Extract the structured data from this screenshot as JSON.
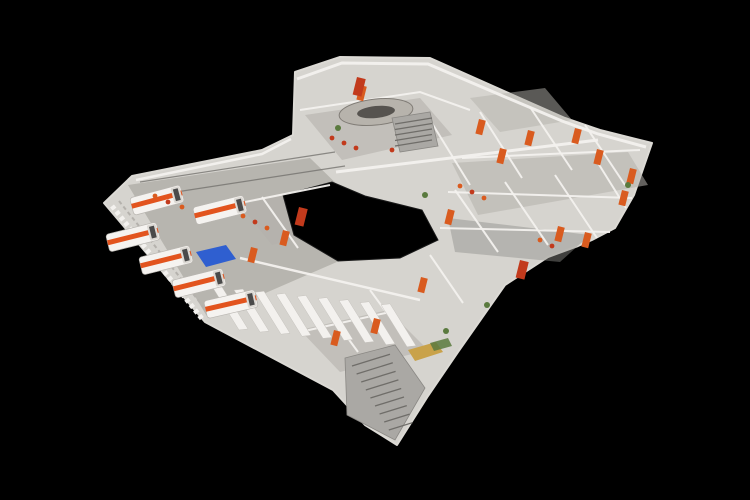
{
  "scene": {
    "type": "3d-dollhouse-scan",
    "subject": "cutaway building scan with ambulance garage, offices and staircases",
    "background": "#000000",
    "palette": {
      "floor_light": "#d6d4cf",
      "floor_mid": "#b4b1ab",
      "floor_dark": "#8f8d89",
      "wall_white": "#f3f1ee",
      "wall_shade": "#dcdad5",
      "accent_orange": "#d95b1f",
      "accent_red": "#c23a1c",
      "ambulance_body": "#f5f3f0",
      "ambulance_stripe": "#e2541e",
      "tarp_blue": "#2f5fd0",
      "table_wood": "#c9a24a",
      "stair_tread": "#aaa8a4",
      "plant_green": "#5a7a3e",
      "line_dark": "#6f6d69"
    },
    "ambulances": [
      [
        133,
        237,
        -14
      ],
      [
        166,
        260,
        -14
      ],
      [
        199,
        283,
        -14
      ],
      [
        231,
        304,
        -13
      ],
      [
        220,
        210,
        -14
      ],
      [
        157,
        200,
        -15
      ]
    ],
    "orange_doors": [
      [
        360,
        85
      ],
      [
        479,
        119
      ],
      [
        528,
        130
      ],
      [
        500,
        148
      ],
      [
        575,
        128
      ],
      [
        597,
        149
      ],
      [
        630,
        168
      ],
      [
        622,
        190
      ],
      [
        585,
        232
      ],
      [
        558,
        226
      ],
      [
        448,
        209
      ],
      [
        421,
        277
      ],
      [
        374,
        318
      ],
      [
        283,
        230
      ],
      [
        251,
        247
      ],
      [
        334,
        330
      ]
    ],
    "red_panels": [
      [
        357,
        77
      ],
      [
        299,
        207
      ],
      [
        520,
        260
      ]
    ],
    "equipment_dots": [
      [
        155,
        196,
        "o"
      ],
      [
        168,
        202,
        "r"
      ],
      [
        182,
        207,
        "o"
      ],
      [
        243,
        216,
        "o"
      ],
      [
        255,
        222,
        "r"
      ],
      [
        267,
        228,
        "o"
      ],
      [
        460,
        186,
        "o"
      ],
      [
        472,
        192,
        "r"
      ],
      [
        484,
        198,
        "o"
      ],
      [
        540,
        240,
        "o"
      ],
      [
        552,
        246,
        "r"
      ],
      [
        332,
        138,
        "r"
      ],
      [
        344,
        143,
        "r"
      ],
      [
        356,
        148,
        "r"
      ],
      [
        392,
        150,
        "r"
      ],
      [
        404,
        146,
        "r"
      ],
      [
        416,
        141,
        "r"
      ],
      [
        628,
        185,
        "g"
      ],
      [
        446,
        331,
        "g"
      ],
      [
        338,
        128,
        "g"
      ],
      [
        487,
        305,
        "g"
      ],
      [
        425,
        195,
        "g"
      ]
    ],
    "dispatch_desk": {
      "cx": 376,
      "cy": 112,
      "rx": 37,
      "ry": 13
    },
    "locker_bays": {
      "count": 9
    },
    "main_stairs": {
      "steps": 9
    },
    "mid_stairs": {
      "steps": 5
    }
  }
}
